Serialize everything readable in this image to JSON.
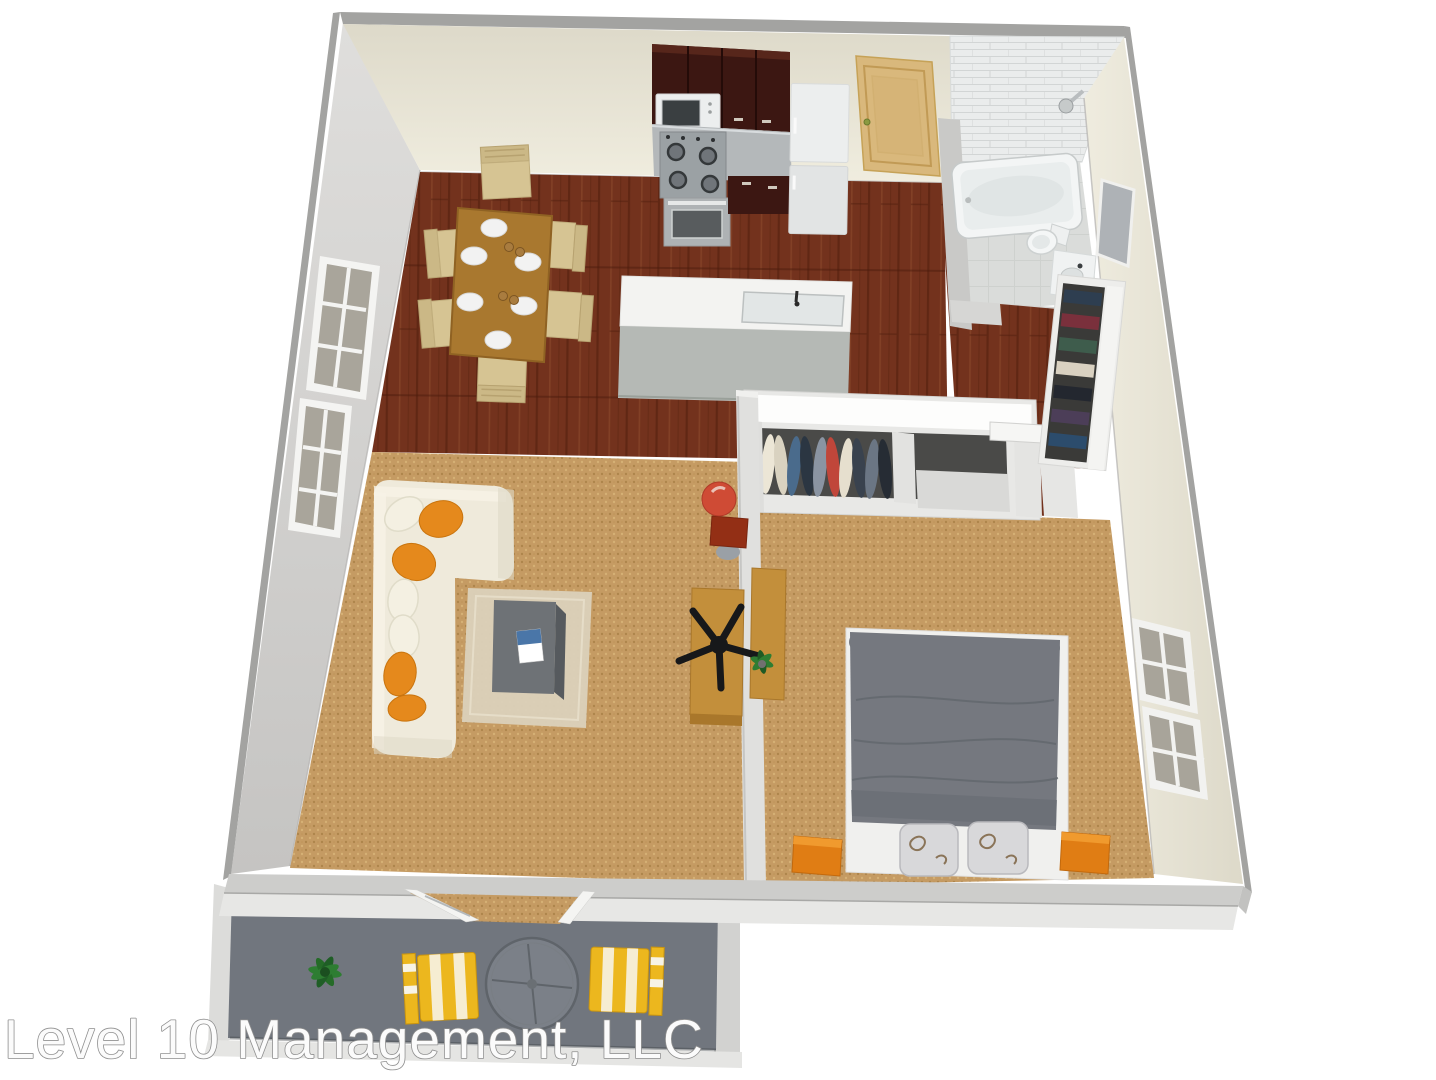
{
  "watermark": {
    "text": "Level 10 Management, LLC",
    "fill": "#fbfbfb",
    "outline": "#8e8e8e"
  },
  "colors": {
    "background": "#ffffff",
    "wall_band": "#a3a3a1",
    "left_wall": "#d2d1cf",
    "top_wall_cream": "#ebe8da",
    "right_wall_cream": "#e9e6d8",
    "bottom_wall": "#cdcdcb",
    "bottom_wall_outer": "#e7e7e5",
    "divider_wall": "#e0e0de",
    "tile_wall": "#eaecec",
    "bathroom_floor": "#dadcda",
    "wood_floor": "#73321d",
    "carpet": "#c59b63",
    "balcony_floor": "#71767e",
    "balcony_wall": "#dcdcda",
    "cabinet_dark": "#3c1712",
    "stainless": "#b4b8ba",
    "appliance_white": "#eceeee",
    "island_top": "#f3f3f1",
    "island_face": "#b5b9b5",
    "entry_door": "#d9b87c",
    "dining_table": "#a9782f",
    "dining_chair": "#d6c493",
    "chair_frame": "#cbb886",
    "plate": "#f2f2f2",
    "sofa": "#efeadb",
    "pillow_orange": "#e5891c",
    "pillow_white": "#f4f0e2",
    "rug": "#dbd1ba",
    "coffee_table": "#6e7276",
    "desk_wood": "#c38f3b",
    "office_chair": "#17181a",
    "bed_blanket": "#75787f",
    "bed_frame": "#f0f0ee",
    "bed_pillow": "#d8d8da",
    "nightstand_orange": "#e07d14",
    "closet_header": "#fdfdfc",
    "closet_interior": "#4a4a48",
    "lamp_red": "#cf4b35",
    "lamp_table": "#932f15",
    "yellow_chair": "#ecb71e",
    "chair_stripe": "#f7f3e6",
    "plant": "#2e7d32",
    "tub_white": "#f3f5f5"
  },
  "scene": {
    "type": "3d-apartment-floor-plan",
    "rooms": [
      {
        "name": "kitchen",
        "items": [
          "upper-cabinets",
          "microwave",
          "gas-stove",
          "oven",
          "lower-cabinets",
          "refrigerator",
          "island-with-sink"
        ]
      },
      {
        "name": "dining-area",
        "items": [
          "dining-table",
          "six-chairs",
          "place-settings"
        ]
      },
      {
        "name": "bathroom",
        "items": [
          "bathtub-shower",
          "toilet",
          "vanity-sink",
          "mirror",
          "tiled-wall"
        ]
      },
      {
        "name": "living-room",
        "items": [
          "l-shaped-sofa",
          "throw-pillows",
          "area-rug",
          "coffee-table",
          "desk",
          "office-chair",
          "red-lamp-side-table"
        ]
      },
      {
        "name": "bedroom",
        "items": [
          "double-bed",
          "two-pillows",
          "orange-nightstands",
          "double-closet",
          "windows"
        ]
      },
      {
        "name": "hallway",
        "items": [
          "linen-closet",
          "open-door"
        ]
      },
      {
        "name": "balcony",
        "items": [
          "two-striped-chairs",
          "round-glass-table",
          "potted-plant",
          "sliding-door"
        ]
      }
    ]
  }
}
